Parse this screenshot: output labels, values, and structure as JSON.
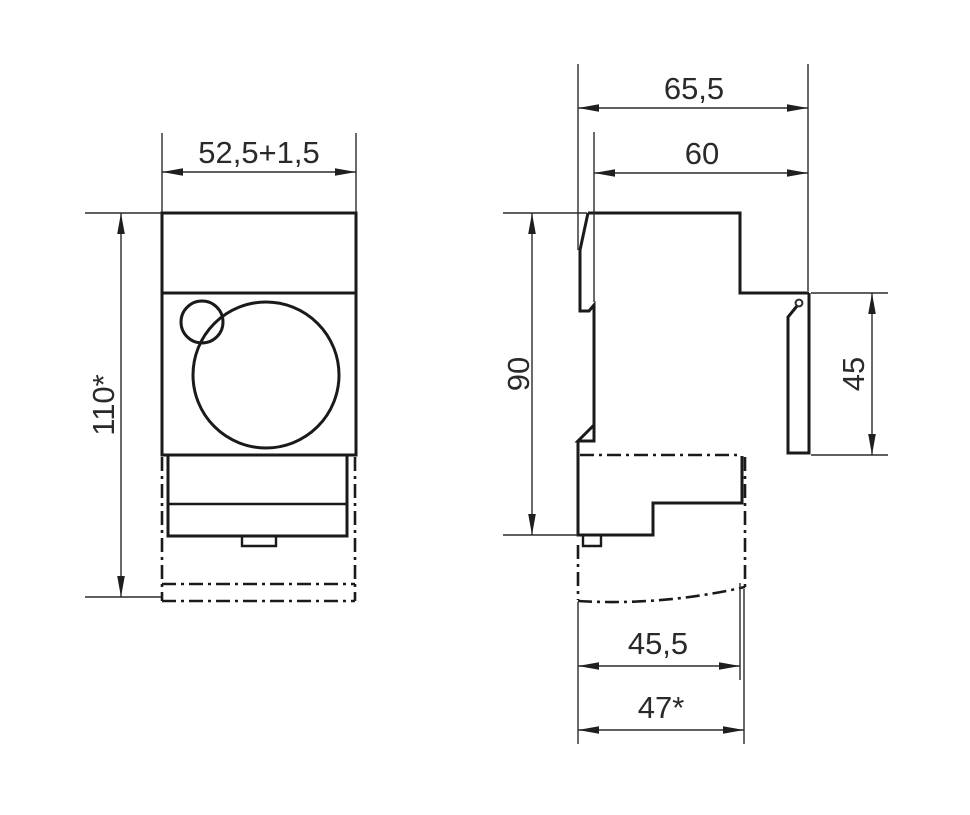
{
  "drawing": {
    "background_color": "#ffffff",
    "line_color": "#1a1a1a",
    "front_view": {
      "dim_width": "52,5+1,5",
      "dim_height": "110*"
    },
    "side_view": {
      "dim_overall_depth": "65,5",
      "dim_body_depth": "60",
      "dim_body_height": "90",
      "dim_cover_height": "45",
      "dim_bottom_depth": "45,5",
      "dim_bottom_overall_depth": "47*"
    }
  }
}
